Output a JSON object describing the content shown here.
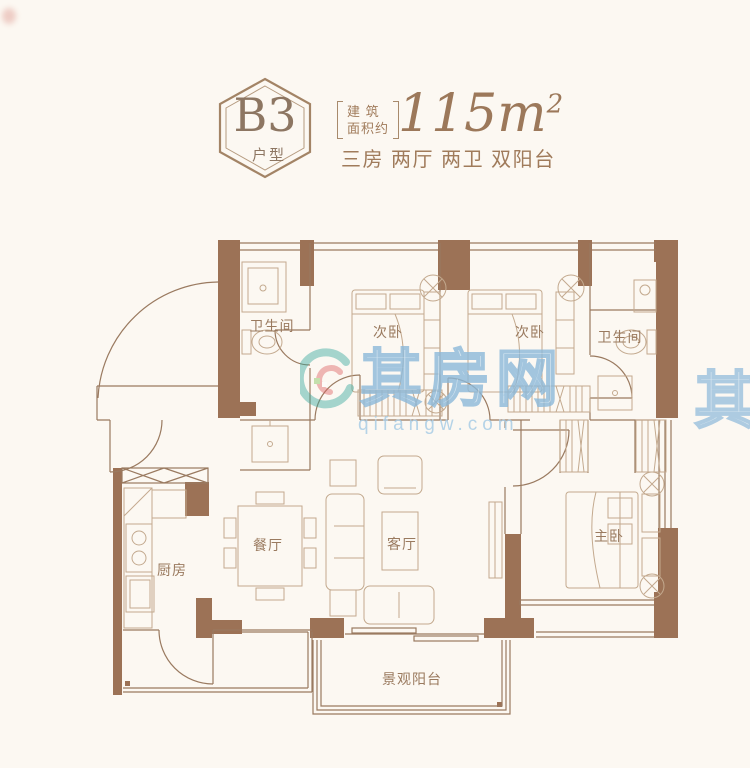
{
  "page": {
    "background": "#fcf8f2"
  },
  "header": {
    "unit_code": "B3",
    "unit_type_label": "户型",
    "area_prefix_line1": "建 筑",
    "area_prefix_line2": "面积约",
    "area_value": "115m",
    "area_sup": "2",
    "description": "三房 两厅 两卫 双阳台",
    "accent_color": "#a07b5b"
  },
  "floorplan": {
    "wall_color": "#9c7256",
    "line_color": "#9a7a60",
    "furniture_color": "#c3a98e",
    "rooms": [
      {
        "id": "bath-left",
        "label": "卫生间"
      },
      {
        "id": "bed-left",
        "label": "次卧"
      },
      {
        "id": "bed-right",
        "label": "次卧"
      },
      {
        "id": "bath-right",
        "label": "卫生间"
      },
      {
        "id": "kitchen",
        "label": "厨房"
      },
      {
        "id": "dining",
        "label": "餐厅"
      },
      {
        "id": "living",
        "label": "客厅"
      },
      {
        "id": "master",
        "label": "主卧"
      },
      {
        "id": "balcony",
        "label": "景观阳台"
      }
    ]
  },
  "watermark": {
    "brand": "其房网",
    "domain": "qifangw.com",
    "fragment": "其",
    "color": "#a9cde6",
    "logo_teal": "#35a79c",
    "logo_red": "#dd5f62",
    "logo_green": "#7cbf52"
  }
}
